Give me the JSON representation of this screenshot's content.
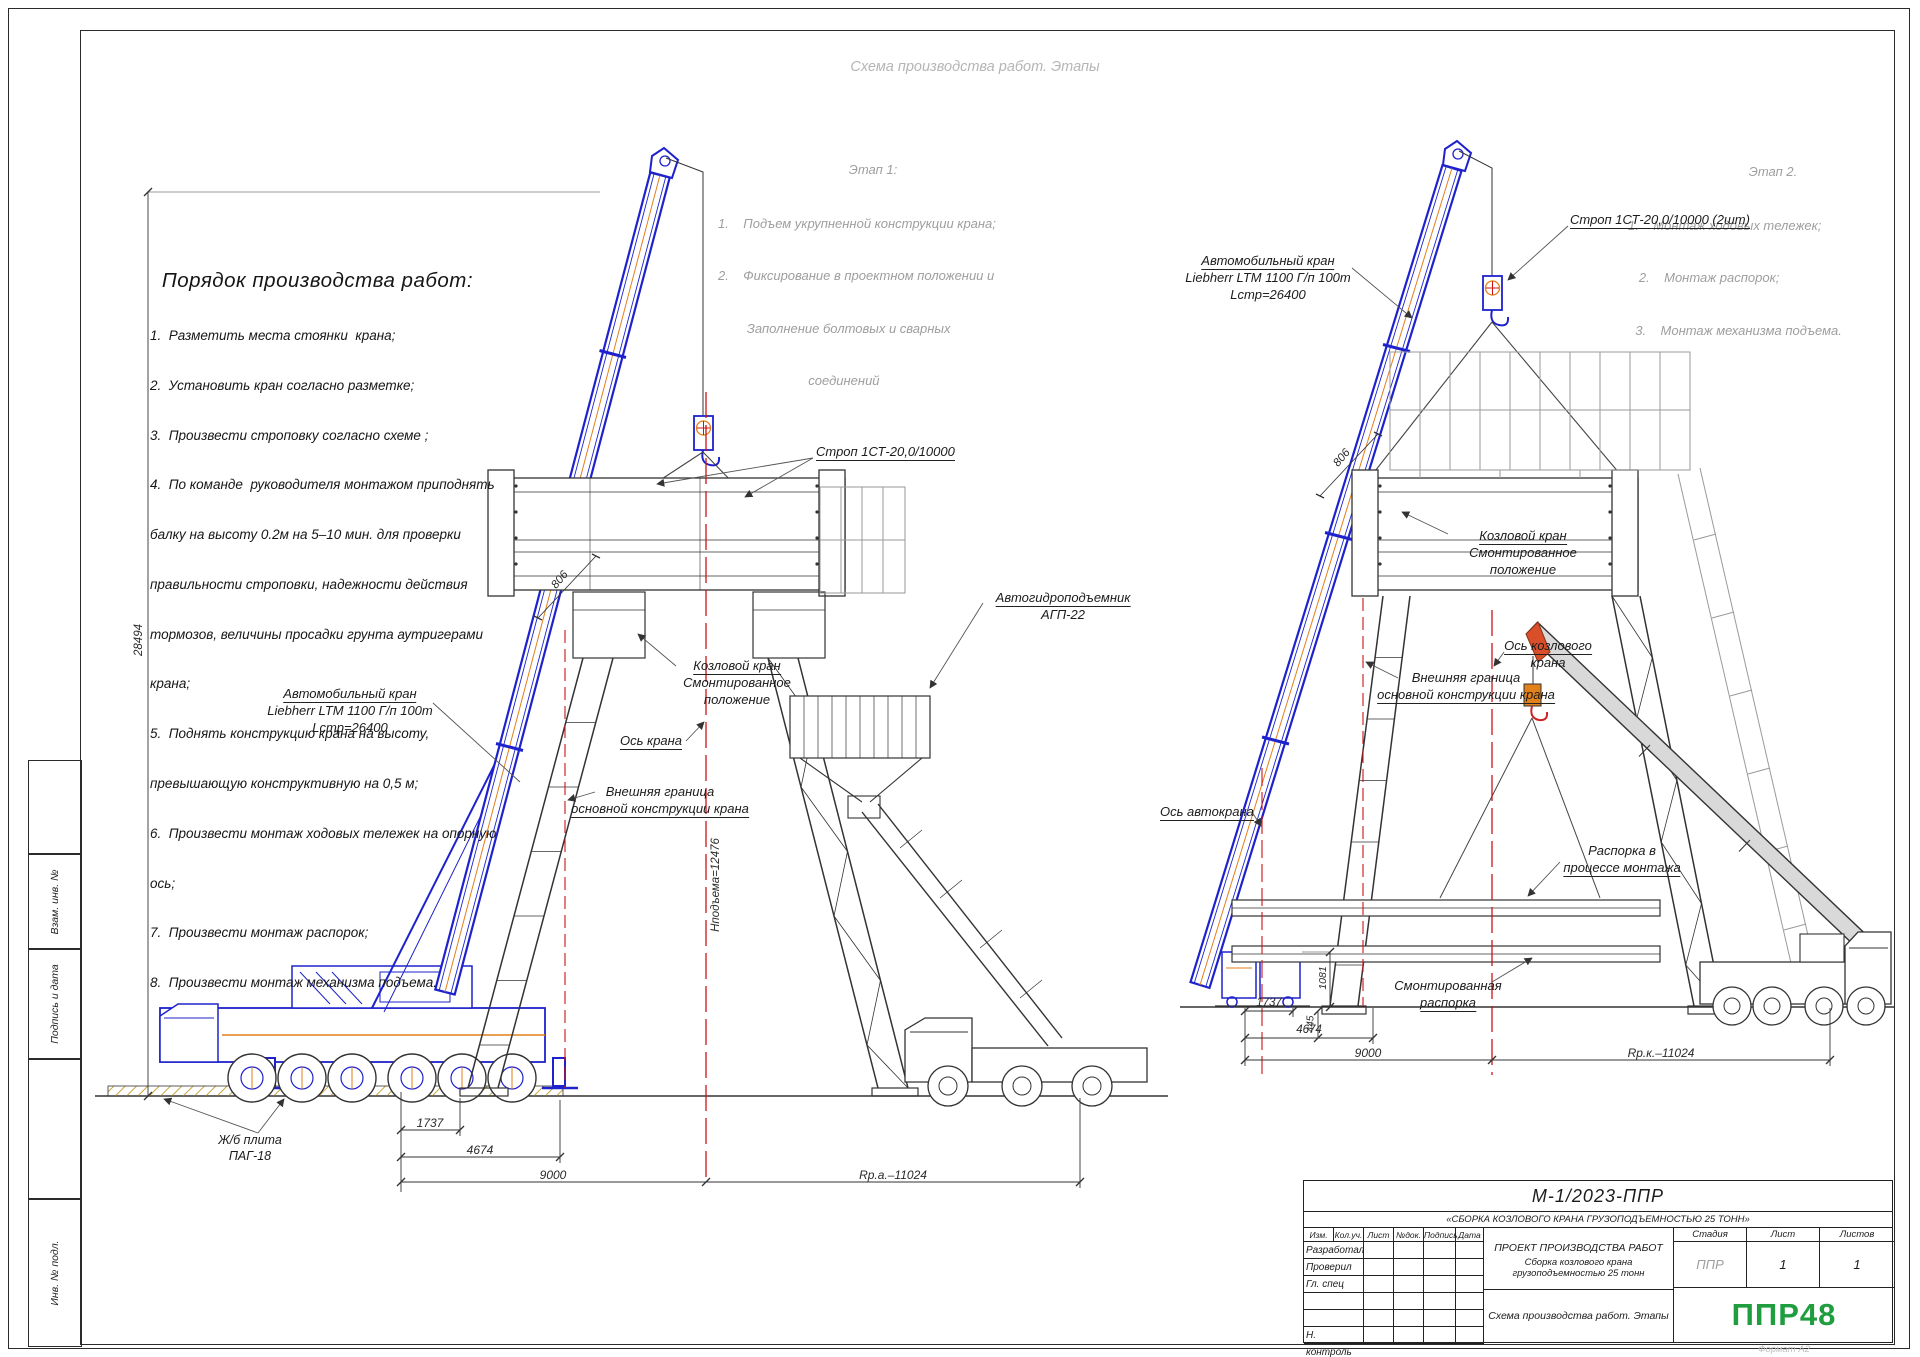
{
  "sheet": {
    "watermark_title": "Схема производства работ. Этапы",
    "format_note": "Формат А2"
  },
  "order": {
    "title": "Порядок производства работ:",
    "lines": [
      "1.  Разметить места стоянки  крана;",
      "2.  Установить кран согласно разметке;",
      "3.  Произвести строповку согласно схеме ;",
      "4.  По команде  руководителя монтажом приподнять",
      "балку на высоту 0.2м на 5–10 мин. для проверки",
      "правильности строповки, надежности действия",
      "тормозов, величины просадки грунта аутригерами",
      "крана;",
      "5.  Поднять конструкцию крана на высоту,",
      "превышающую конструктивную на 0,5 м;",
      "6.  Произвести монтаж ходовых тележек на опорную",
      "ось;",
      "7.  Произвести монтаж распорок;",
      "8.  Произвести монтаж механизма подъема."
    ]
  },
  "stage1": {
    "title": "Этап 1:",
    "lines": [
      "1.    Подъем укрупненной конструкции крана;",
      "2.    Фиксирование в проектном положении и",
      "        Заполнение болтовых и сварных",
      "                         соединений"
    ]
  },
  "stage2": {
    "title": "Этап 2.",
    "lines": [
      "1.    Монтаж ходовых тележек;",
      "   2.    Монтаж распорок;",
      "  3.    Монтаж механизма подъема."
    ]
  },
  "left_view": {
    "crane_label": {
      "l1": "Автомобильный кран",
      "l2": "Liebherr LTM 1100 Г/п 100т",
      "l3": "Lстр=26400"
    },
    "sling_label": "Строп 1СТ-20,0/10000",
    "gantry_label": {
      "l1": "Козловой кран",
      "l2": "Смонтированное",
      "l3": "положение"
    },
    "axis_label": "Ось крана",
    "boundary_label": {
      "l1": "Внешняя граница",
      "l2": "основной конструкции крана"
    },
    "lift_label": {
      "l1": "Автогидроподъемник",
      "l2": "АГП-22"
    },
    "plate_label": {
      "l1": "Ж/б плита",
      "l2": "ПАГ-18"
    },
    "dims": {
      "d1": "1737",
      "d2": "4674",
      "d3": "9000",
      "radius": "Rр.а.–11024",
      "height_total": "28494",
      "boom": "806",
      "lift_height": "Hподъема=12476"
    }
  },
  "right_view": {
    "crane_label": {
      "l1": "Автомобильный кран",
      "l2": "Liebherr LTM 1100 Г/п 100т",
      "l3": "Lстр=26400"
    },
    "sling_label": "Строп 1СТ-20,0/10000 (2шт)",
    "gantry_label": {
      "l1": "Козловой кран",
      "l2": "Смонтированное",
      "l3": "положение"
    },
    "axis_label": {
      "l1": "Ось козлового",
      "l2": "крана"
    },
    "boundary_label": {
      "l1": "Внешняя граница",
      "l2": "основной конструкции крана"
    },
    "truck_axis_label": "Ось автокрана",
    "strut_label": {
      "l1": "Распорка в",
      "l2": "процессе монтажа"
    },
    "mounted_strut_label": {
      "l1": "Смонтированная",
      "l2": "распорка"
    },
    "dims": {
      "v1": "1081",
      "d1": "1737",
      "v2": "445",
      "d2": "4674",
      "d3": "9000",
      "radius": "Rр.к.–11024",
      "boom": "806"
    }
  },
  "title_block": {
    "doc_number": "М-1/2023-ППР",
    "doc_title": "«СБОРКА КОЗЛОВОГО КРАНА ГРУЗОПОДЪЕМНОСТЬЮ 25 ТОНН»",
    "cols": {
      "c1": "Изм.",
      "c2": "Кол.уч.",
      "c3": "Лист",
      "c4": "№док.",
      "c5": "Подпись",
      "c6": "Дата"
    },
    "rows": {
      "r1": "Разработал",
      "r2": "Проверил",
      "r3": "Гл. спец",
      "r6": "Н. контроль"
    },
    "project_name": "ПРОЕКТ ПРОИЗВОДСТВА РАБОТ",
    "project_subtitle": "Сборка козлового крана грузоподъемностью 25 тонн",
    "sheet_name": "Схема производства работ. Этапы",
    "stage": {
      "label": "Стадия",
      "value": "ППР"
    },
    "sheet": {
      "label": "Лист",
      "value": "1"
    },
    "sheets": {
      "label": "Листов",
      "value": "1"
    },
    "logo": "ППР48"
  },
  "frame": {
    "stamp1": "Взам. инв. №",
    "stamp2": "Подпись и дата",
    "stamp3": "Инв. № подл."
  }
}
